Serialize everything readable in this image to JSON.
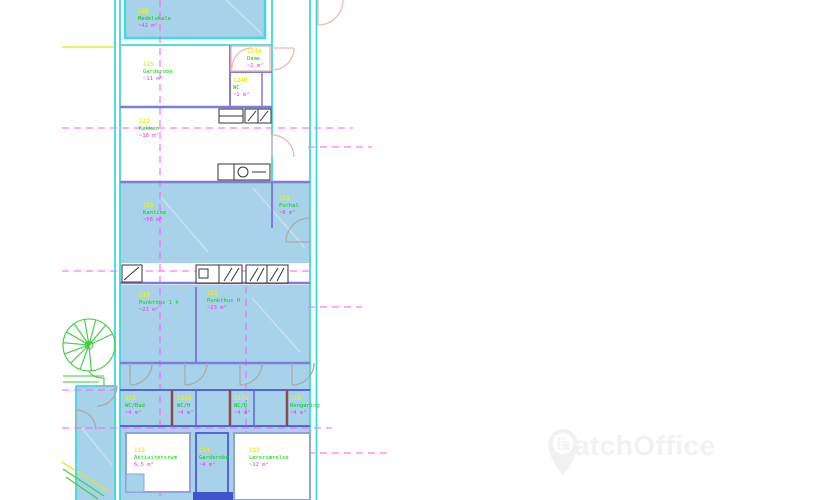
{
  "watermark": {
    "brand": "MatchOffice",
    "icon": "map-pin-building-icon",
    "color": "#f2f2f2"
  },
  "floorplan": {
    "type": "architectural-floor-plan",
    "colors": {
      "wall_cyan": "#3fd9de",
      "wall_purple": "#7d7de0",
      "wall_blue": "#5566dd",
      "wall_maroon": "#8a4a4a",
      "room_fill": "#a7d2ea",
      "grid_magenta": "#ff5aff",
      "label_number": "#f0f000",
      "label_name": "#00d400",
      "label_area": "#f335f3",
      "door_pink": "#f2b6b6",
      "door_gray": "#aaaaaa",
      "stair_green": "#3ecc3e",
      "guide_yellow": "#e8e800"
    },
    "rooms": [
      {
        "number": "126",
        "name": "Mødelokale",
        "area": "~42 m²"
      },
      {
        "number": "125",
        "name": "Garderobe",
        "area": "~11 m²"
      },
      {
        "number": "124A",
        "name": "Dame",
        "area": "~2 m²"
      },
      {
        "number": "124B",
        "name": "WC",
        "area": "~1 m²"
      },
      {
        "number": "122",
        "name": "Køkken",
        "area": "~18 m²"
      },
      {
        "number": "120",
        "name": "Kantine",
        "area": "~56 m²"
      },
      {
        "number": "111",
        "name": "Forhal",
        "area": "~8 m²"
      },
      {
        "number": "119",
        "name": "Punkthus 1 h",
        "area": "~21 m²"
      },
      {
        "number": "121",
        "name": "Punkthus H",
        "area": "~23 m²"
      },
      {
        "number": "118",
        "name": "WC/Bad",
        "area": "~4 m²"
      },
      {
        "number": "117A",
        "name": "WC/H",
        "area": "~4 m²"
      },
      {
        "number": "117B",
        "name": "WC/D",
        "area": "~4 m²"
      },
      {
        "number": "116",
        "name": "Rengøring",
        "area": "~4 m²"
      },
      {
        "number": "115",
        "name": "Aktivitetsrum",
        "area": "6,5 m²"
      },
      {
        "number": "114",
        "name": "Garderobe",
        "area": "~4 m²"
      },
      {
        "number": "113",
        "name": "Lærerværelse",
        "area": "~12 m²"
      }
    ]
  }
}
